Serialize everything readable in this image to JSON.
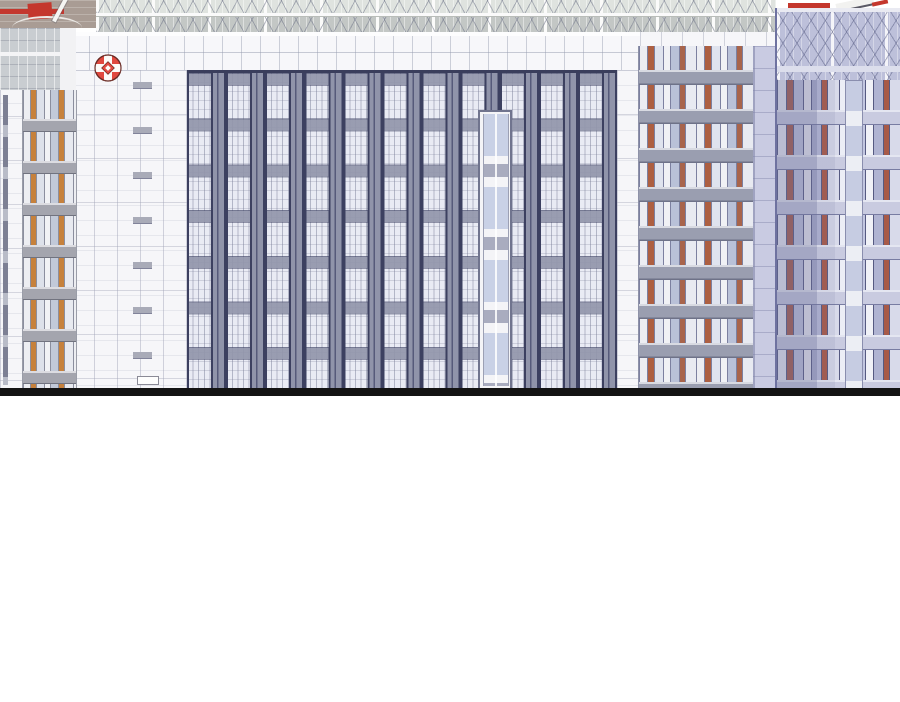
{
  "panel": {
    "aria_label": "Webtoon panel: illustrated hospital building complex above a thick black ground line, blank white space below",
    "description": "Architectural comic illustration. A wide central hospital block with a white grid frame, a red roundel cross logo, and a dark navy curtain-wall facade of repeating window bays; an orange-accented mid-rise on the right; a narrow balcony tower on the left; a lavender-hazed high-rise at the far right; rooftop glass trusses and a helipad deck with red markings on top."
  },
  "icons": {
    "hospital_logo": "red-roundel-cross-icon",
    "helipad_marks": "red-helipad-stripe-icon"
  },
  "palette": {
    "logo_red": "#e0493f",
    "logo_outline": "#6a2a24",
    "facade_white": "#f6f6f9",
    "mullion_navy": "#3c4060",
    "spandrel_gray": "#9296ab",
    "glass_light": "#e9ebf4",
    "accent_orange": "#ad5f41",
    "accent_amber": "#c6813c",
    "lavender_haze": "#c9cbe2",
    "rooftop_taupe": "#a99c94",
    "helipad_red": "#c4372d",
    "ground_line_black": "#141414",
    "background_white": "#ffffff"
  },
  "scene": {
    "regions": [
      {
        "name": "rooftop-deck",
        "desc": "taupe helipad deck with red stripe markings, top left"
      },
      {
        "name": "truss-band",
        "desc": "rooftop glass conservatory with X-braced trusses spanning the top"
      },
      {
        "name": "logo-wall",
        "desc": "white gridded wall bearing the red hospital roundel"
      },
      {
        "name": "curtain-facade",
        "desc": "dark navy vertical window bays, 11 bays x 7 floors"
      },
      {
        "name": "core-column",
        "desc": "white elevator core with stacked blue windows"
      },
      {
        "name": "orange-tower",
        "desc": "mid-rise with orange, white and blue window panels"
      },
      {
        "name": "left-tower",
        "desc": "narrow balcony tower with amber window frames"
      },
      {
        "name": "farright-building",
        "desc": "lavender-tinted high-rise with terracotta panels and rooftop truss"
      },
      {
        "name": "ground-line",
        "desc": "thick black horizontal ground line"
      },
      {
        "name": "blank-below",
        "desc": "empty white webtoon gutter"
      }
    ]
  }
}
